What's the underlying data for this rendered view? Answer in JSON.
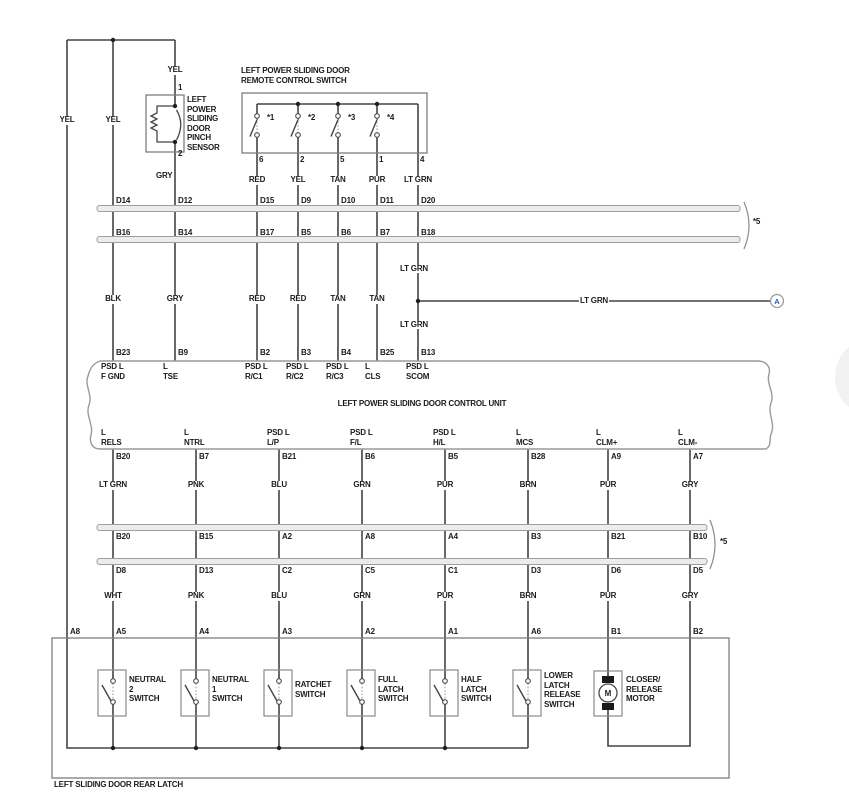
{
  "top_feeds": {
    "left": "YEL",
    "mid": "YEL",
    "sensor": "YEL"
  },
  "pinch_sensor": {
    "pin_top": "1",
    "pin_bottom": "2",
    "wire_out": "GRY",
    "name": "LEFT\nPOWER\nSLIDING\nDOOR\nPINCH\nSENSOR"
  },
  "remote_switch": {
    "title": "LEFT POWER SLIDING DOOR\nREMOTE CONTROL SWITCH",
    "switches": [
      "*1",
      "*2",
      "*3",
      "*4"
    ],
    "pins": [
      "6",
      "2",
      "5",
      "1",
      "4"
    ],
    "wires": [
      "RED",
      "YEL",
      "TAN",
      "PUR",
      "LT GRN"
    ]
  },
  "connector1": {
    "note": "*5",
    "top_row": [
      "D14",
      "D12",
      "D15",
      "D9",
      "D10",
      "D11",
      "D20"
    ],
    "bottom_row": [
      "B16",
      "B14",
      "B17",
      "B5",
      "B6",
      "B7",
      "B18"
    ]
  },
  "harness_mid": {
    "wires": [
      "BLK",
      "GRY",
      "RED",
      "RED",
      "TAN",
      "TAN"
    ],
    "lt_grn_upper": "LT GRN",
    "branch_wire": "LT GRN",
    "lt_grn_lower": "LT GRN",
    "branch_ref": "A"
  },
  "control_unit": {
    "title": "LEFT POWER SLIDING DOOR CONTROL UNIT",
    "top_pins": [
      {
        "num": "B23",
        "name": "PSD L\nF GND"
      },
      {
        "num": "B9",
        "name": "L\nTSE"
      },
      {
        "num": "B2",
        "name": "PSD L\nR/C1"
      },
      {
        "num": "B3",
        "name": "PSD L\nR/C2"
      },
      {
        "num": "B4",
        "name": "PSD L\nR/C3"
      },
      {
        "num": "B25",
        "name": "L\nCLS"
      },
      {
        "num": "B13",
        "name": "PSD L\nSCOM"
      }
    ],
    "bottom_pins": [
      {
        "name": "L\nRELS",
        "num": "B20",
        "wire": "LT GRN"
      },
      {
        "name": "L\nNTRL",
        "num": "B7",
        "wire": "PNK"
      },
      {
        "name": "PSD L\nL/P",
        "num": "B21",
        "wire": "BLU"
      },
      {
        "name": "PSD L\nF/L",
        "num": "B6",
        "wire": "GRN"
      },
      {
        "name": "PSD L\nH/L",
        "num": "B5",
        "wire": "PUR"
      },
      {
        "name": "L\nMCS",
        "num": "B28",
        "wire": "BRN"
      },
      {
        "name": "L\nCLM+",
        "num": "A9",
        "wire": "PUR"
      },
      {
        "name": "L\nCLM-",
        "num": "A7",
        "wire": "GRY"
      }
    ]
  },
  "connector2": {
    "note": "*5",
    "top_row": [
      "B20",
      "B15",
      "A2",
      "A8",
      "A4",
      "B3",
      "B21",
      "B10"
    ],
    "bottom_row": [
      "D8",
      "D13",
      "C2",
      "C5",
      "C1",
      "D3",
      "D6",
      "D5"
    ]
  },
  "harness_lower": {
    "wires": [
      "WHT",
      "PNK",
      "BLU",
      "GRN",
      "PUR",
      "BRN",
      "PUR",
      "GRY"
    ]
  },
  "rear_latch": {
    "label": "LEFT SLIDING DOOR REAR LATCH",
    "pins": [
      "A8",
      "A5",
      "A4",
      "A3",
      "A2",
      "A1",
      "A6",
      "B1",
      "B2"
    ],
    "components": [
      {
        "name": "NEUTRAL\n2\nSWITCH"
      },
      {
        "name": "NEUTRAL\n1\nSWITCH"
      },
      {
        "name": "RATCHET\nSWITCH"
      },
      {
        "name": "FULL\nLATCH\nSWITCH"
      },
      {
        "name": "HALF\nLATCH\nSWITCH"
      },
      {
        "name": "LOWER\nLATCH\nRELEASE\nSWITCH"
      },
      {
        "name": "CLOSER/\nRELEASE\nMOTOR",
        "symbol": "M"
      }
    ]
  }
}
